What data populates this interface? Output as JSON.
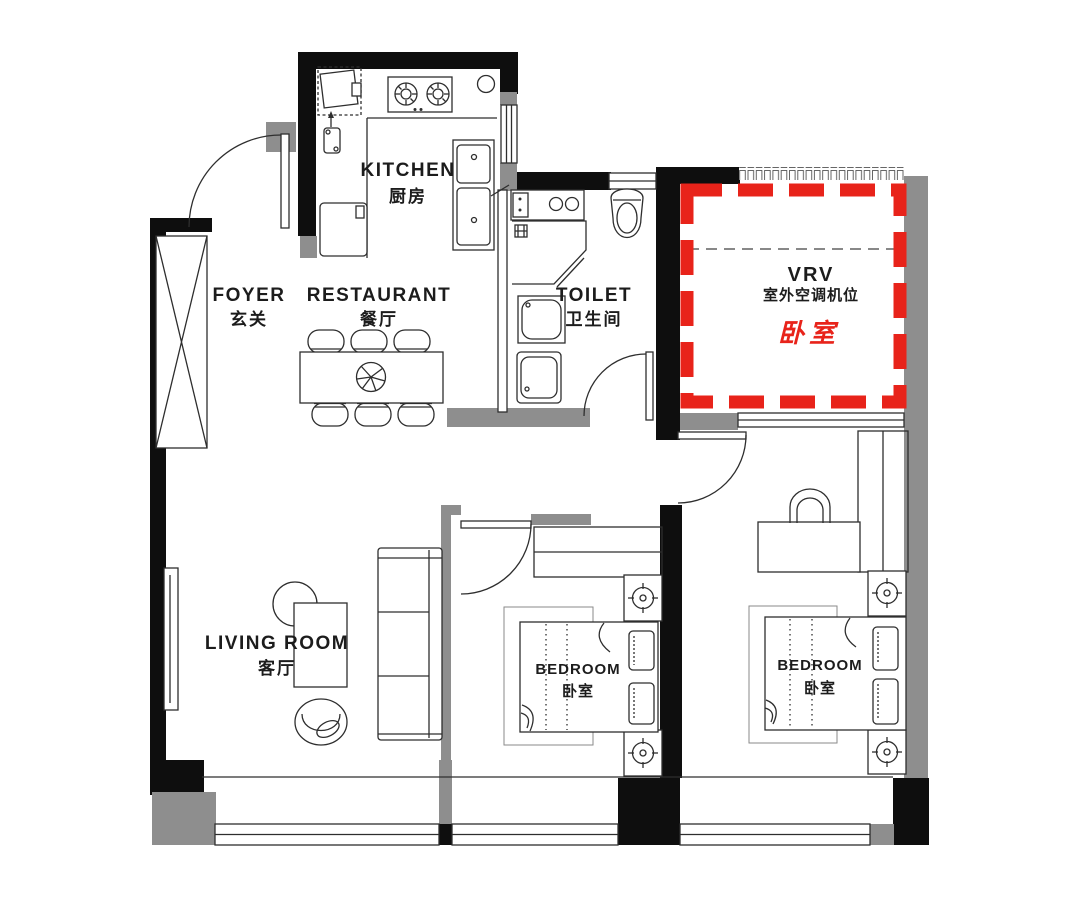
{
  "title": "Apartment floor plan",
  "colors": {
    "wall_black": "#0e0e0e",
    "wall_gray": "#8e8e8e",
    "accent_red": "#e8231a",
    "line": "#2e2e2e"
  },
  "rooms": {
    "kitchen": {
      "name_en": "KITCHEN",
      "name_cn": "厨房"
    },
    "foyer": {
      "name_en": "FOYER",
      "name_cn": "玄关"
    },
    "restaurant": {
      "name_en": "RESTAURANT",
      "name_cn": "餐厅"
    },
    "toilet": {
      "name_en": "TOILET",
      "name_cn": "卫生间"
    },
    "living_room": {
      "name_en": "LIVING ROOM",
      "name_cn": "客厅"
    },
    "bedroom_1": {
      "name_en": "BEDROOM",
      "name_cn": "卧室"
    },
    "bedroom_2": {
      "name_en": "BEDROOM",
      "name_cn": "卧室"
    },
    "vrv_area": {
      "name": "VRV",
      "subtitle_cn": "室外空调机位",
      "highlight_cn": "卧室"
    }
  }
}
